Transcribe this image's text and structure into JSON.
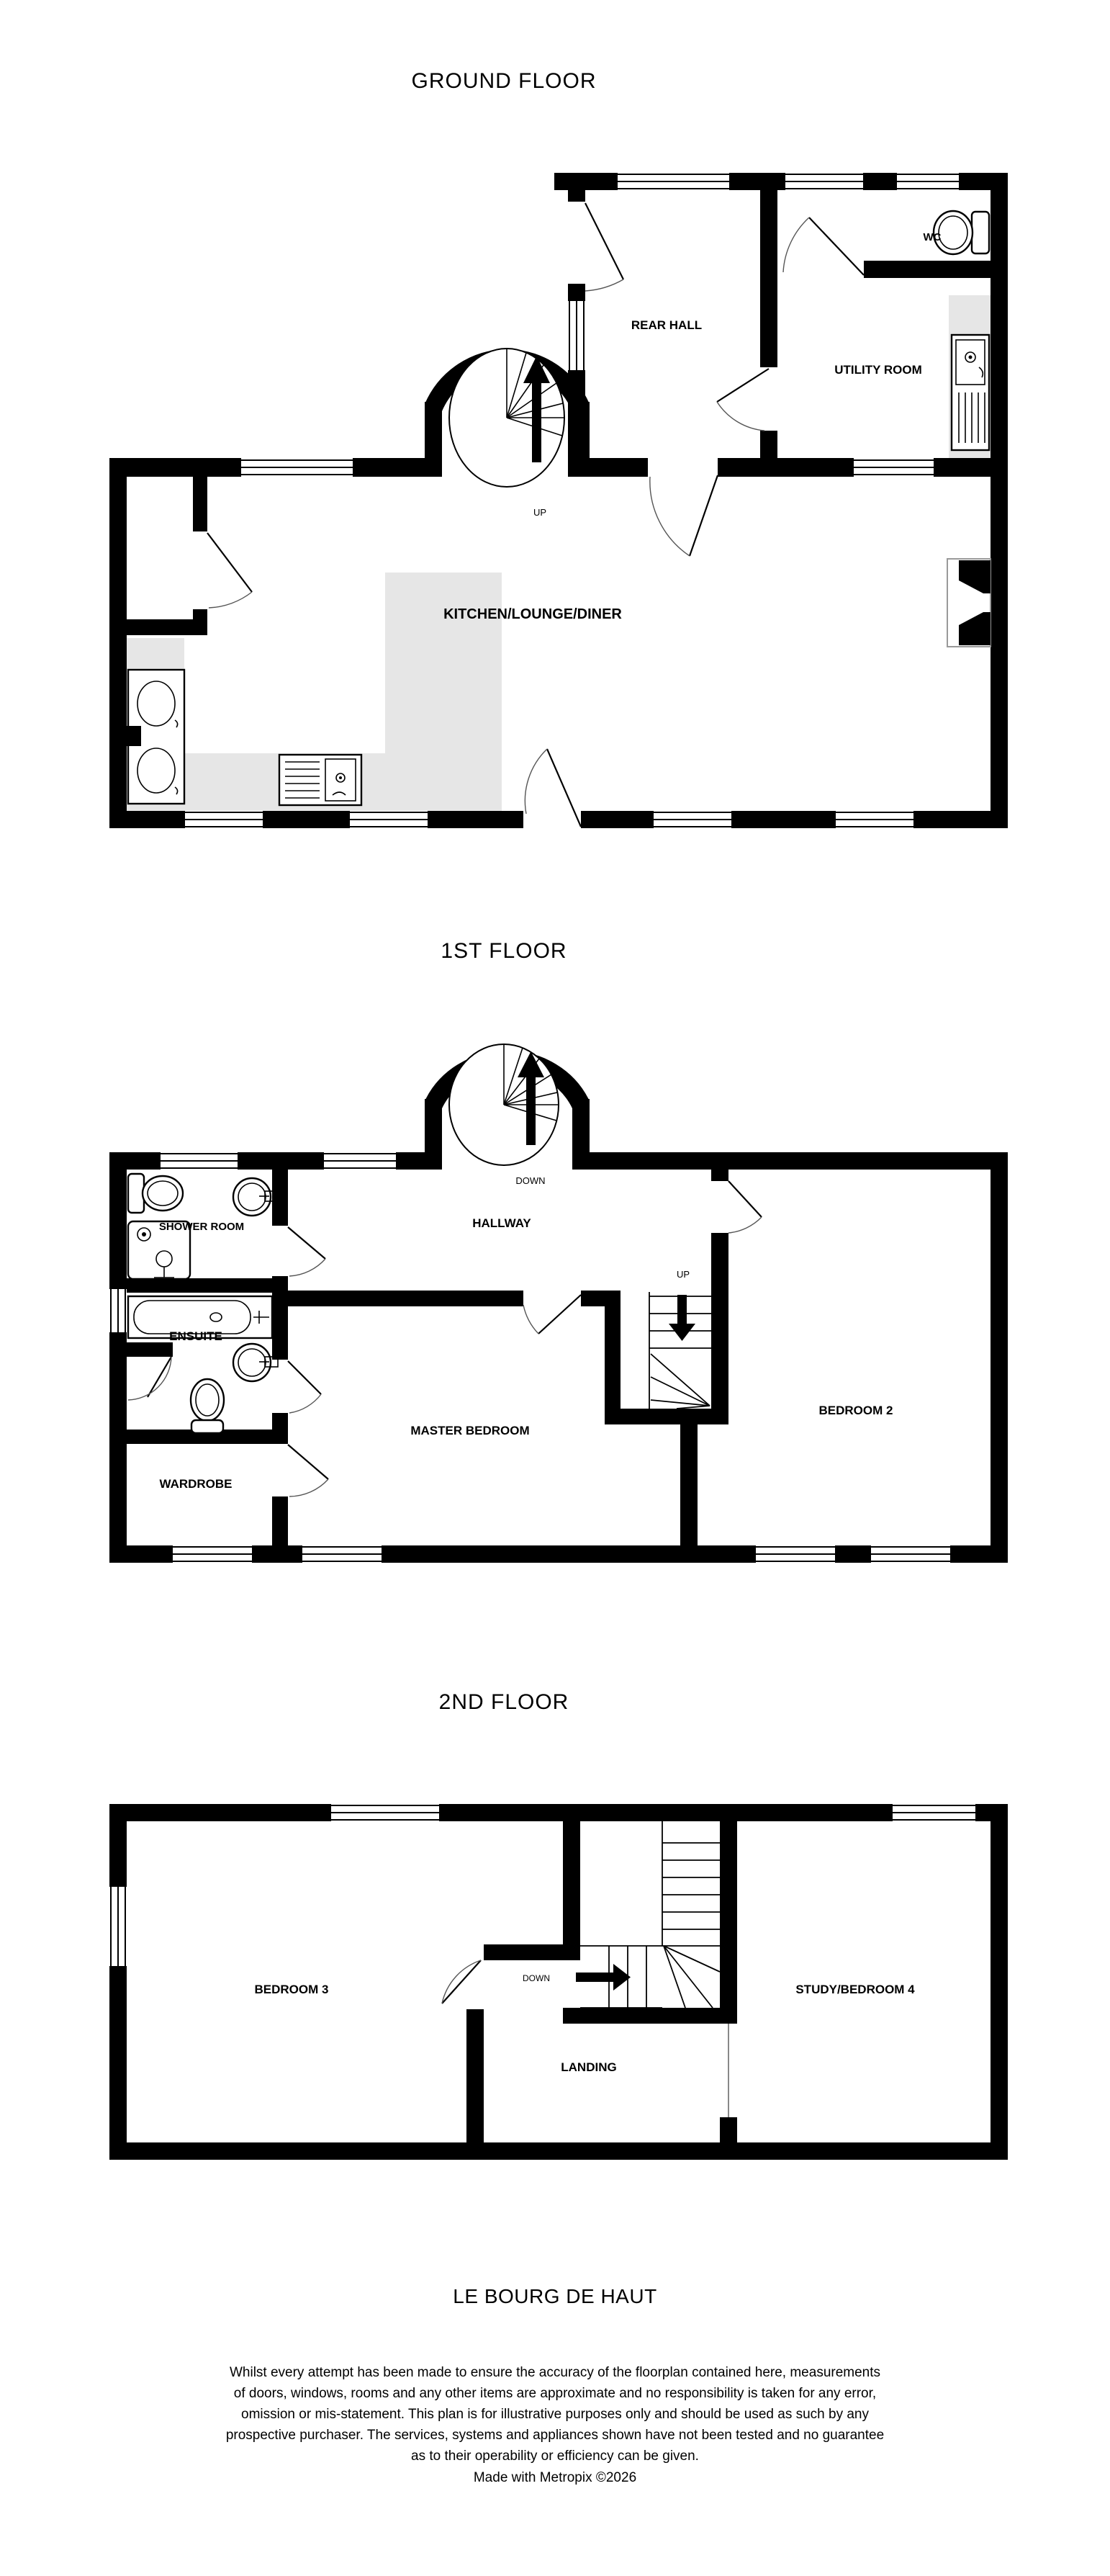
{
  "document": {
    "type": "estate-agent floorplan",
    "background_color": "#ffffff",
    "wall_color": "#000000",
    "counter_color": "#e6e6e6"
  },
  "floors": [
    {
      "id": "ground",
      "title": "GROUND FLOOR",
      "rooms": [
        "REAR HALL",
        "WC",
        "UTILITY ROOM",
        "KITCHEN/LOUNGE/DINER"
      ],
      "stairs": [
        {
          "type": "spiral",
          "label": "UP"
        }
      ],
      "fixtures": [
        "toilet",
        "utility-sink",
        "cooker",
        "kitchen-sink",
        "fireplace"
      ]
    },
    {
      "id": "first",
      "title": "1ST FLOOR",
      "rooms": [
        "SHOWER ROOM",
        "HALLWAY",
        "ENSUITE",
        "MASTER BEDROOM",
        "BEDROOM 2",
        "WARDROBE"
      ],
      "stairs": [
        {
          "type": "spiral",
          "label": "DOWN"
        },
        {
          "type": "straight",
          "label": "UP"
        }
      ],
      "fixtures": [
        "toilet",
        "basin",
        "shower",
        "bath",
        "basin",
        "toilet"
      ]
    },
    {
      "id": "second",
      "title": "2ND FLOOR",
      "rooms": [
        "BEDROOM 3",
        "LANDING",
        "STUDY/BEDROOM 4"
      ],
      "stairs": [
        {
          "type": "quarter-turn",
          "label": "DOWN"
        }
      ],
      "fixtures": []
    }
  ],
  "footer": {
    "property_name": "LE BOURG DE HAUT",
    "disclaimer_lines": [
      "Whilst every attempt has been made to ensure the accuracy of the floorplan contained here, measurements",
      "of doors, windows, rooms and any other items are approximate and no responsibility is taken for any error,",
      "omission or mis-statement. This plan is for illustrative purposes only and should be used as such by any",
      "prospective purchaser. The services, systems and appliances shown have not been tested and no guarantee",
      "as to their operability or efficiency can be given."
    ],
    "credit": "Made with Metropix ©2026"
  }
}
